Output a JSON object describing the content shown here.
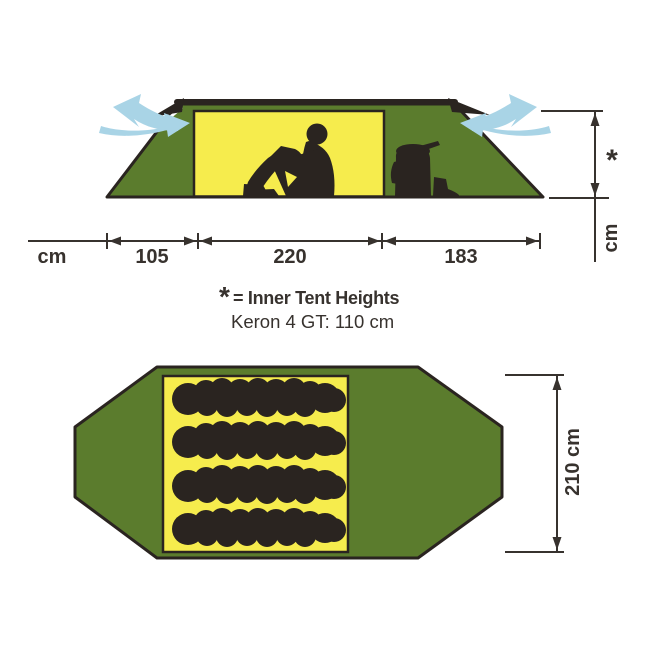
{
  "colors": {
    "tent_green": "#5b7c2d",
    "inner_yellow": "#f6ec4d",
    "silhouette_dark": "#2a2420",
    "vent_blue": "#a9d4e6",
    "dimension_dark": "#37322e",
    "background": "#ffffff"
  },
  "side_view": {
    "unit_label": "cm",
    "segments": [
      {
        "label": "105"
      },
      {
        "label": "220"
      },
      {
        "label": "183"
      }
    ],
    "height_marker": "*",
    "height_unit_label": "cm"
  },
  "note": {
    "marker": "*",
    "heading": "= Inner Tent Heights",
    "model_line": "Keron 4 GT: 110 cm"
  },
  "top_view": {
    "length_label": "210 cm"
  }
}
